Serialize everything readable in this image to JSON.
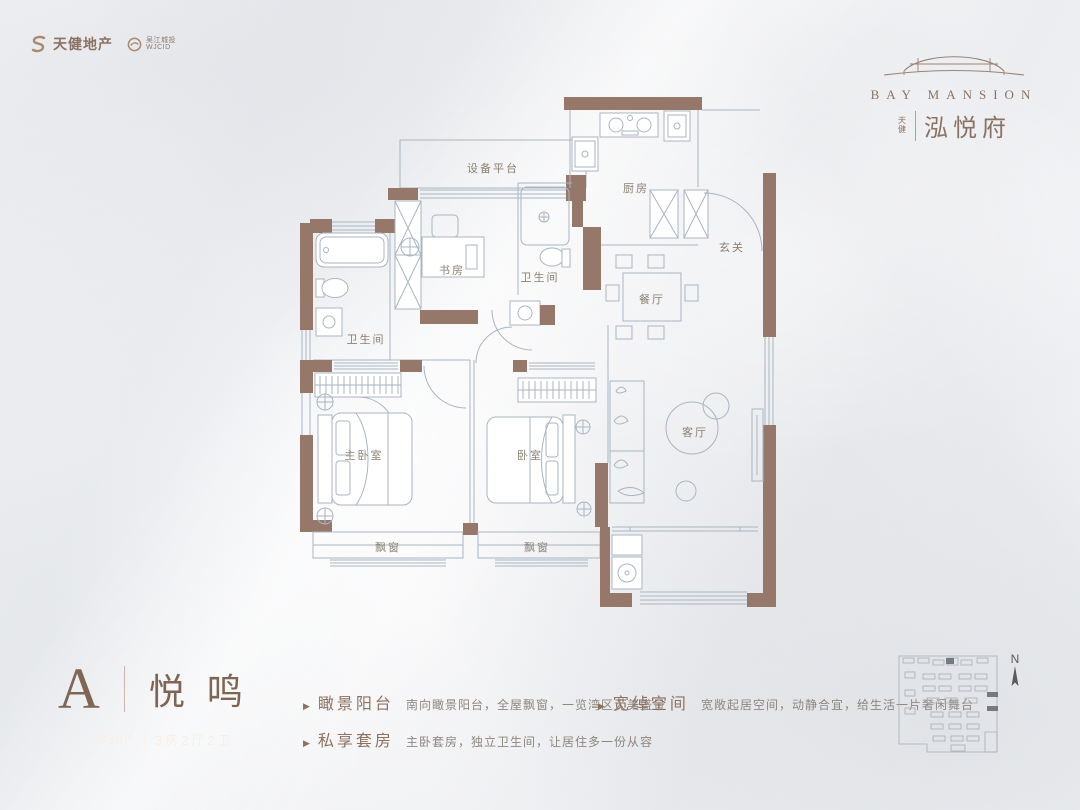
{
  "header": {
    "logo_primary": {
      "name": "天健地产"
    },
    "logo_secondary": {
      "name": "吴江城投",
      "sub": "WJCID"
    },
    "brand": {
      "english": "BAY MANSION",
      "prefix": "天健",
      "chinese": "泓悦府"
    }
  },
  "plan": {
    "wall_color": "#95786a",
    "line_color": "#a9b5c1",
    "rooms": [
      {
        "label": "设备平台"
      },
      {
        "label": "厨房"
      },
      {
        "label": "玄关"
      },
      {
        "label": "书房"
      },
      {
        "label": "卫生间"
      },
      {
        "label": "餐厅"
      },
      {
        "label": "卫生间"
      },
      {
        "label": "主卧室"
      },
      {
        "label": "卧室"
      },
      {
        "label": "客厅"
      },
      {
        "label": "飘窗"
      },
      {
        "label": "飘窗"
      }
    ]
  },
  "unit": {
    "type": "A",
    "name": "悦鸣",
    "area_prefix": "建面",
    "area": "•103m²",
    "divider": "|",
    "layout": "3房2厅2卫"
  },
  "features": [
    {
      "marker": "▶",
      "title": "瞰景阳台",
      "desc": "南向瞰景阳台，全屋飘窗，一览湾区大美盛景"
    },
    {
      "marker": "▶",
      "title": "私享套房",
      "desc": "主卧套房，独立卫生间，让居住多一份从容"
    },
    {
      "marker": "▶",
      "title": "宽绰空间",
      "desc": "宽敞起居空间，动静合宜，给生活一片奢闲舞台"
    }
  ],
  "siteplan": {
    "compass": "N"
  }
}
